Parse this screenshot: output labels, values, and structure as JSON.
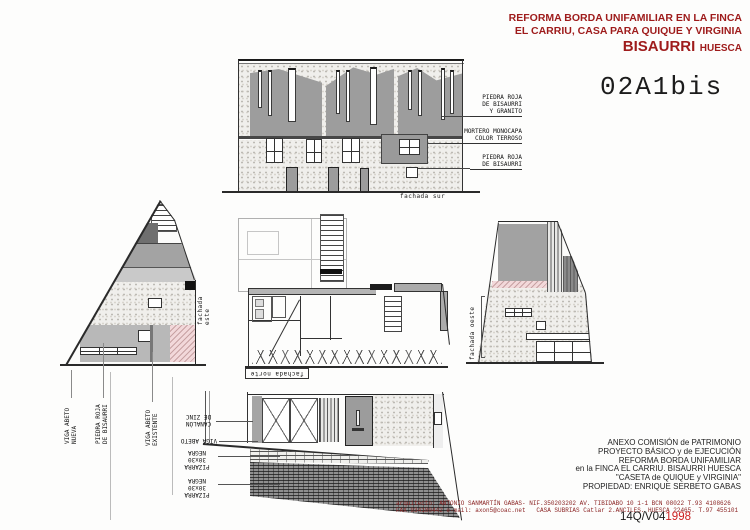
{
  "colors": {
    "accent_red": "#9e1b1b",
    "footer_red": "#8b2424",
    "ref_red": "#cc2020",
    "pink_render": "#f2d8da"
  },
  "header": {
    "line1": "REFORMA BORDA UNIFAMILIAR EN LA FINCA",
    "line2": "EL CARRIU, CASA PARA QUIQUE Y VIRGINIA",
    "town": "BISAURRI",
    "province": "HUESCA"
  },
  "sheet_code": "02A1bis",
  "south": {
    "label": "fachada sur",
    "ann_stone_granite": "PIEDRA ROJA\nDE BISAURRI\nY GRANITO",
    "ann_mortar": "MORTERO MONOCAPA\nCOLOR TERROSO",
    "ann_stone": "PIEDRA ROJA\nDE BISAURRI"
  },
  "east": {
    "label": "fachada este",
    "ann_beam_new": "VIGA ABETO\nNUEVA",
    "ann_stone": "PIEDRA ROJA\nDE BISAURRI",
    "ann_beam_old": "VIGA ABETO\nEXISTENTE"
  },
  "west": {
    "label": "fachada oeste"
  },
  "north": {
    "label": "fachada norte",
    "ann_gutter": "CANALÓN\nDE ZINC",
    "ann_beam": "VIGA ABETO",
    "ann_slate1": "PIZARRA 30x30\nNEGRA",
    "ann_slate2": "PIZARRA 30x30\nNEGRA"
  },
  "titleblock": {
    "line1": "ANEXO COMISIÓN de PATRIMONIO",
    "line2": "PROYECTO BÁSICO y de EJECUCIÓN",
    "line3": "REFORMA BORDA UNIFAMILIAR",
    "line4": "en la FINCA EL CARRIU. BISAURRI HUESCA",
    "line5": "\"CASETA de QUIQUE y VIRGINIA\"",
    "line6": "PROPIEDAD: ENRIQUE SERBETO GABAS"
  },
  "footer": {
    "line1": "arquitecto: ANTONIO SANMARTÍN GABAS- NIF.350203202 AV. TIBIDABO 10 1-1 BCN 08022 T.93 4108626",
    "line2": "FAX 934180442 e-mail: axon5@coac.net   CASA SUBRIAS Catlar 2.ANCILES. HUESCA 22465. T.97 455101",
    "ref_black": "14Q/V04",
    "ref_red": "1998"
  }
}
